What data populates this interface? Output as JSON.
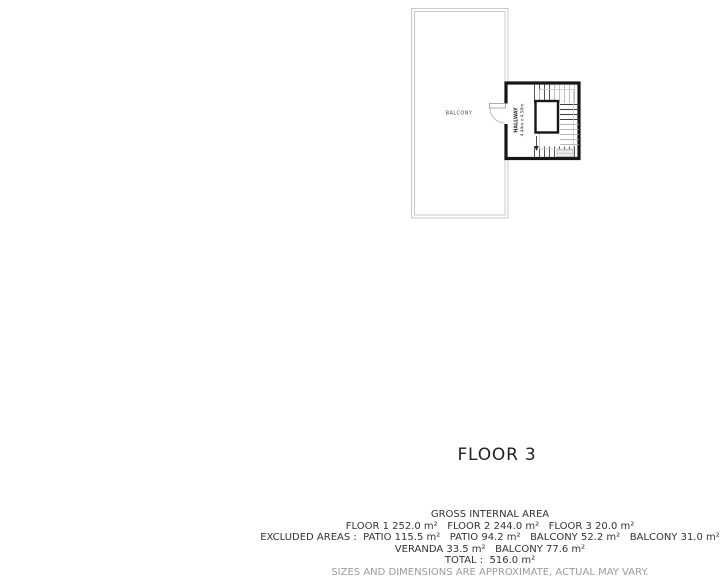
{
  "title": "FLOOR 3",
  "plan": {
    "balcony_label": "BALCONY",
    "hallway_label": "HALLWAY",
    "hallway_dimensions": "4.44m x 4.50m"
  },
  "area_summary": {
    "heading": "GROSS INTERNAL AREA",
    "floors_line": "FLOOR 1 252.0 m²   FLOOR 2 244.0 m²   FLOOR 3 20.0 m²",
    "excluded_line": "EXCLUDED AREAS :  PATIO 115.5 m²   PATIO 94.2 m²   BALCONY 52.2 m²   BALCONY 31.0 m²",
    "excluded_line_2": "VERANDA 33.5 m²   BALCONY 77.6 m²",
    "total_line": "TOTAL :  516.0 m²",
    "disclaimer": "SIZES AND DIMENSIONS ARE APPROXIMATE, ACTUAL MAY VARY."
  },
  "colors": {
    "wall": "#161616",
    "balcony_outline": "#c9c9c9",
    "stair_tread_dark": "#3f3f3f",
    "stair_tread_light": "#b8b8b8",
    "text_dark": "#333333",
    "disclaimer_gray": "#9c9c9c"
  }
}
